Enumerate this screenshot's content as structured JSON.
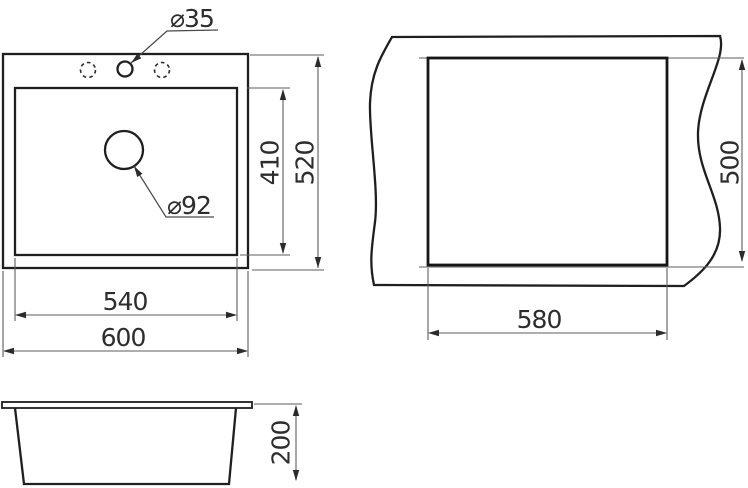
{
  "drawing": {
    "labels": {
      "faucet_hole_diameter": "⌀35",
      "drain_hole_diameter": "⌀92",
      "bowl_length": "410",
      "sink_length": "520",
      "bowl_width": "540",
      "sink_width": "600",
      "cutout_width": "580",
      "cutout_length": "500",
      "sink_depth": "200"
    },
    "colors": {
      "outline": "#1f1f1f",
      "dimension_line": "#5e5e5e",
      "text": "#2d2d2d",
      "background": "#ffffff"
    }
  }
}
